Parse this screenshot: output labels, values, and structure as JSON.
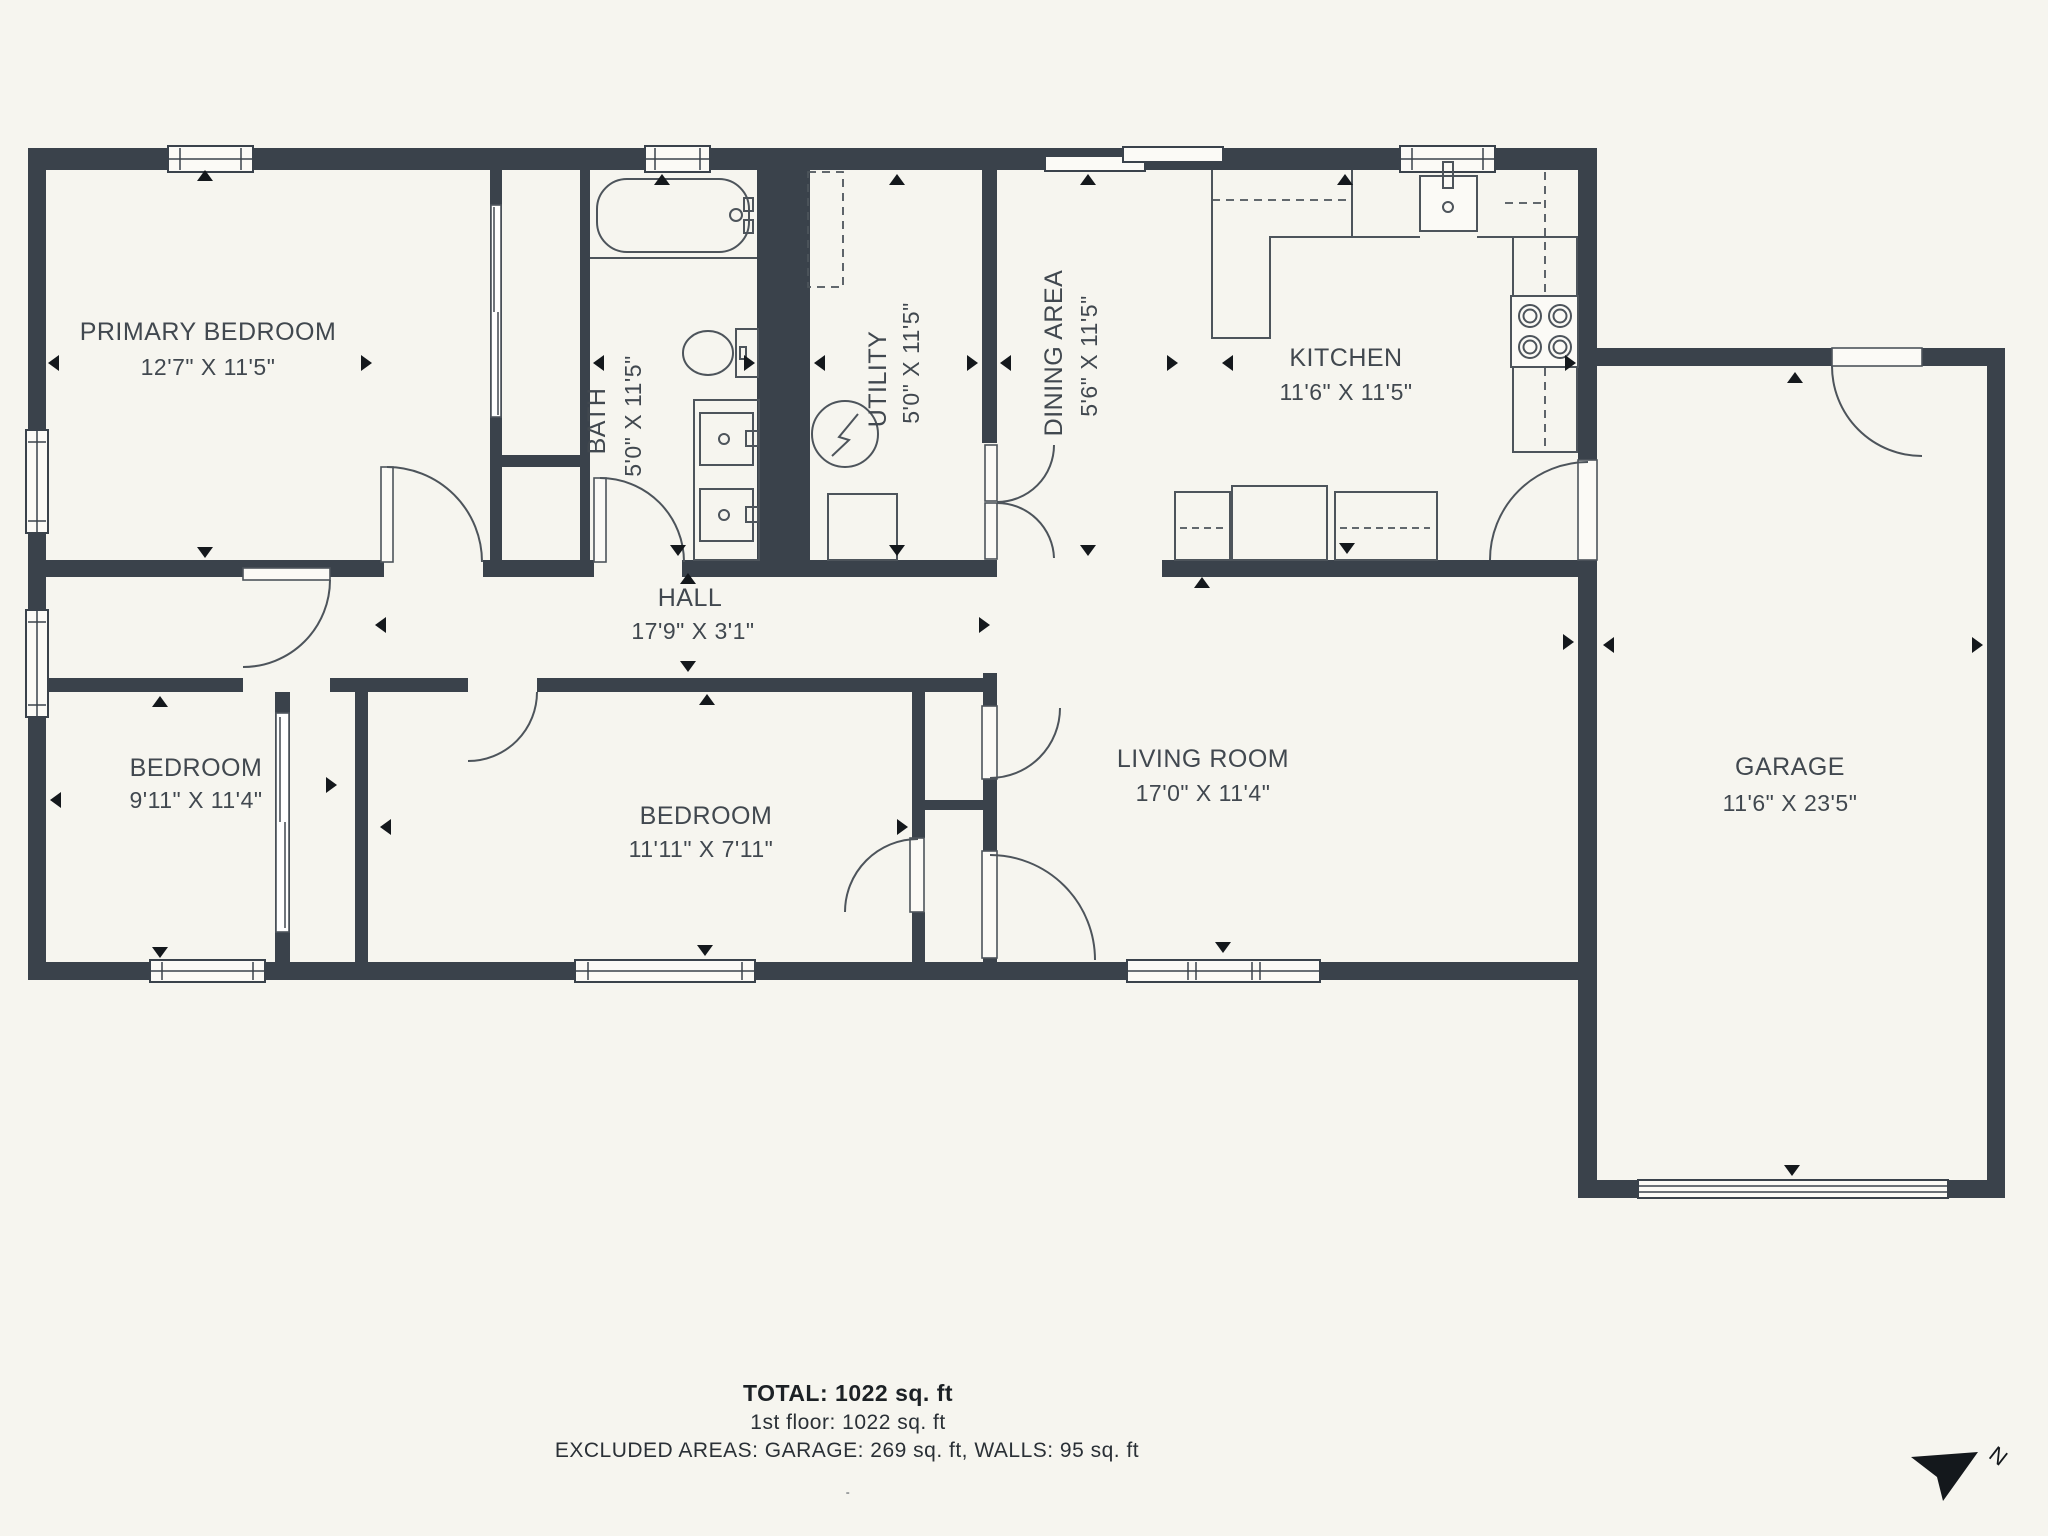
{
  "floorplan": {
    "rooms": [
      {
        "name": "PRIMARY BEDROOM",
        "dims": "12'7\" X 11'5\""
      },
      {
        "name": "BATH",
        "dims": "5'0\" X 11'5\""
      },
      {
        "name": "UTILITY",
        "dims": "5'0\" X 11'5\""
      },
      {
        "name": "DINING AREA",
        "dims": "5'6\" X 11'5\""
      },
      {
        "name": "KITCHEN",
        "dims": "11'6\" X 11'5\""
      },
      {
        "name": "HALL",
        "dims": "17'9\" X 3'1\""
      },
      {
        "name": "BEDROOM",
        "dims": "9'11\" X 11'4\""
      },
      {
        "name": "BEDROOM",
        "dims": "11'11\" X 7'11\""
      },
      {
        "name": "LIVING ROOM",
        "dims": "17'0\" X 11'4\""
      },
      {
        "name": "GARAGE",
        "dims": "11'6\" X 23'5\""
      }
    ],
    "summary": {
      "total": "TOTAL: 1022 sq. ft",
      "first_floor": "1st floor: 1022 sq. ft",
      "excluded": "EXCLUDED AREAS: GARAGE: 269 sq. ft, WALLS: 95 sq. ft",
      "mark": "-"
    },
    "compass": {
      "label": "N"
    },
    "colors": {
      "background": "#f6f5ef",
      "wall": "#3a424b",
      "line": "#4d545b",
      "text": "#41484f",
      "marker": "#14181c"
    }
  }
}
